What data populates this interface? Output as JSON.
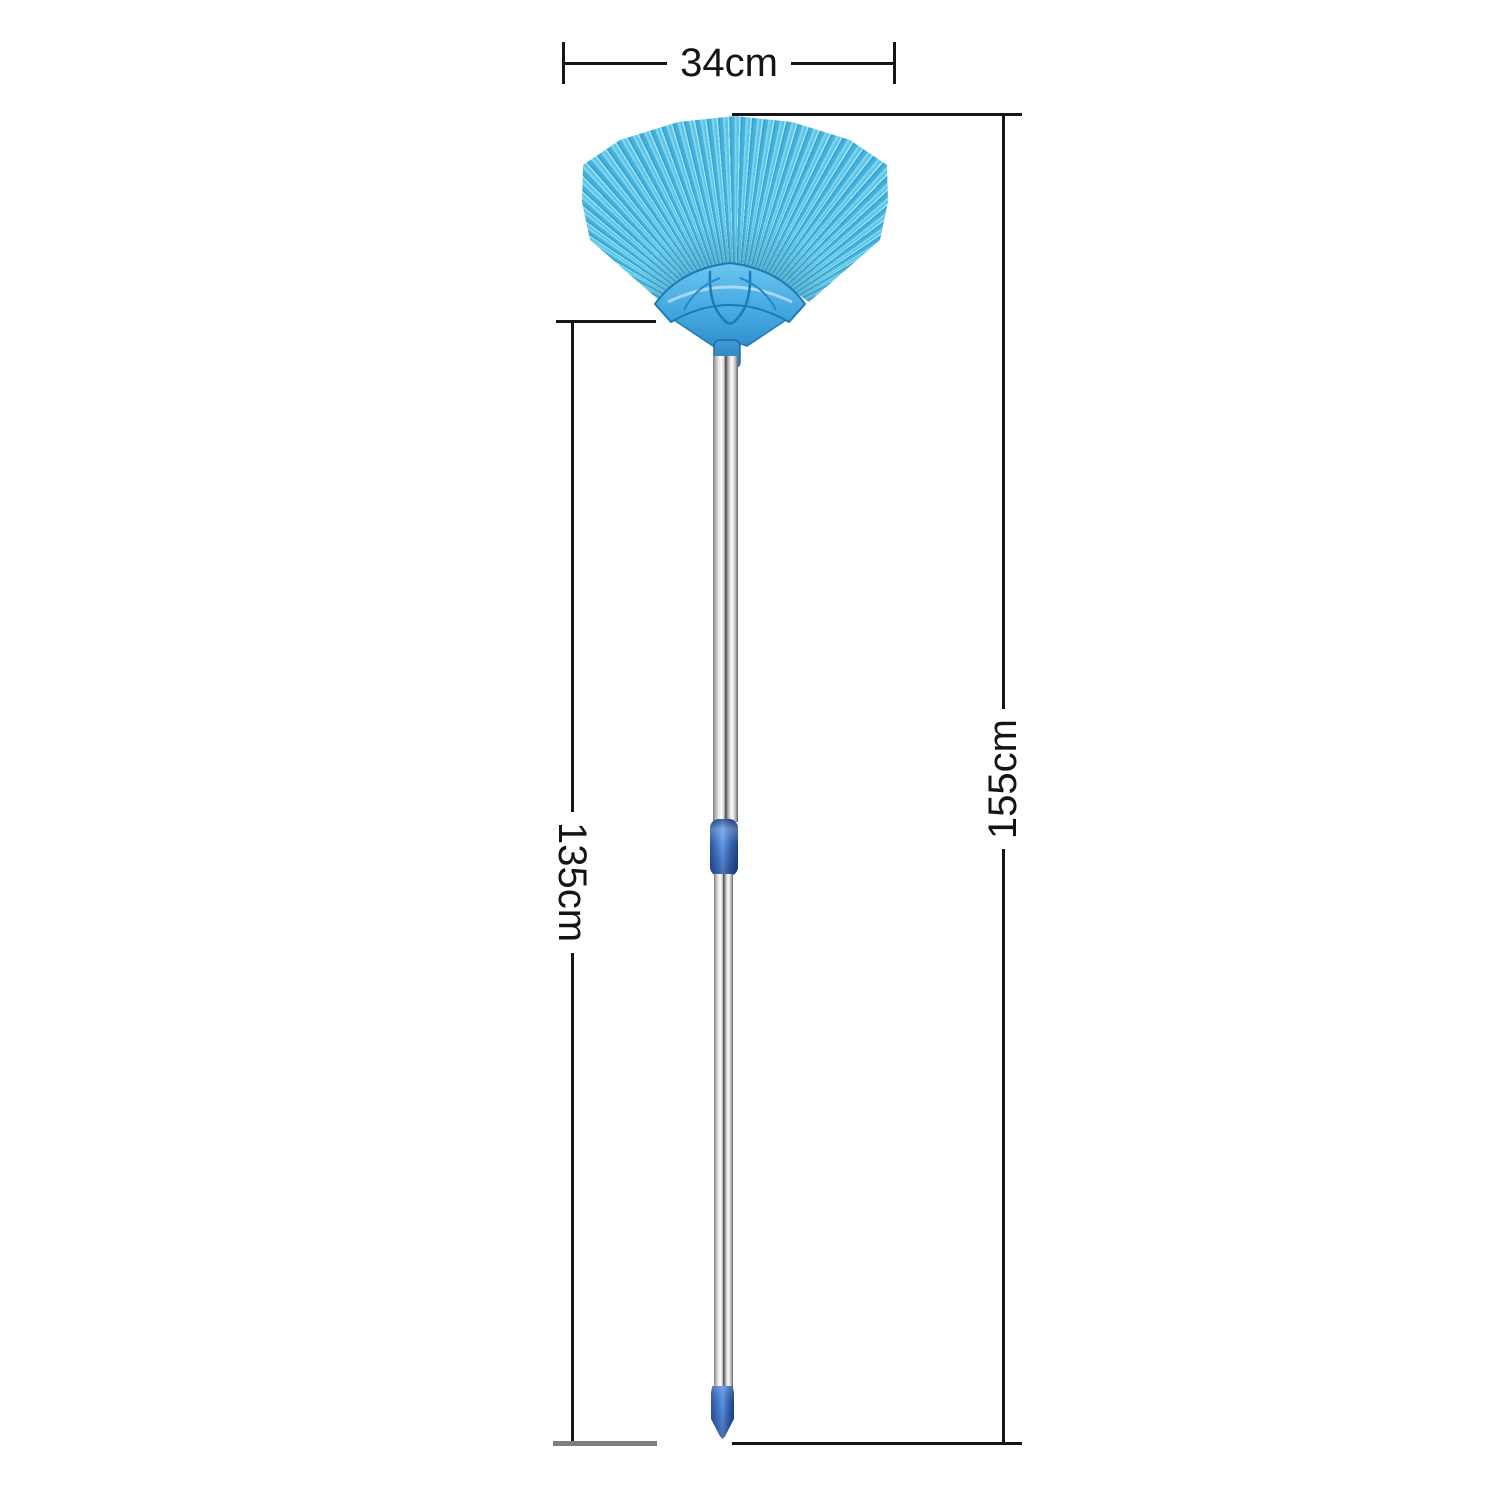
{
  "figure": {
    "description": "Blue fan-shaped duster broom with telescopic silver handle, shown with size dimensions"
  },
  "annotations": {
    "head_width": {
      "label": "34cm"
    },
    "pole_length": {
      "label": "135cm"
    },
    "total_length": {
      "label": "155cm"
    }
  },
  "colors": {
    "dimension_line": "#161616",
    "baseline_gray": "#7e7e7e",
    "bristle_light": "#a6e3f3",
    "bristle_mid": "#5ac6e7",
    "bristle_dark": "#3ba5d2",
    "holder_blue": "#3fa9e2",
    "connector_blue": "#4d82d4",
    "tip_blue": "#3565b2",
    "pole_silver": "#d2d2d2"
  }
}
